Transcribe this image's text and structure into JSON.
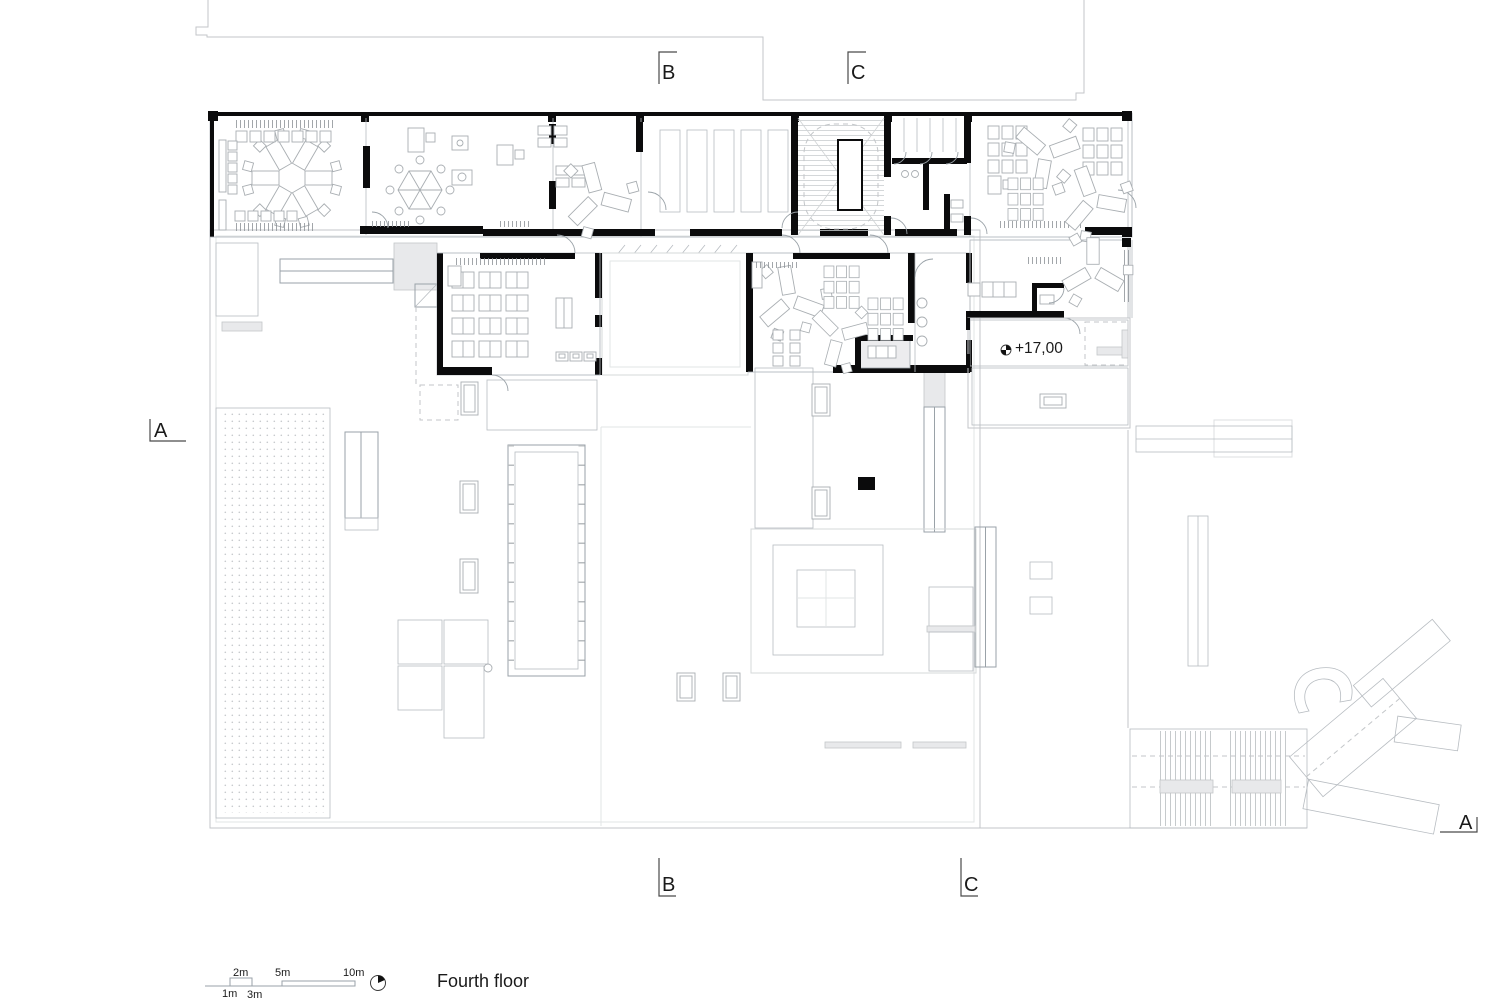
{
  "drawing": {
    "title": "Fourth floor",
    "elevation_label": "+17,00"
  },
  "section_markers": {
    "top_b": "B",
    "top_c": "C",
    "bottom_b": "B",
    "bottom_c": "C",
    "left_a": "A",
    "right_a": "A"
  },
  "scale_bar": {
    "labels": {
      "m1": "1m",
      "m2": "2m",
      "m3": "3m",
      "m5": "5m",
      "m10": "10m"
    }
  },
  "icons": {
    "north_arrow": "north-arrow-icon",
    "level_marker": "level-marker-icon"
  },
  "colors": {
    "background": "#ffffff",
    "highlight_fill": "#e9edf2",
    "wall": "#0b0b0c",
    "site_line": "#c3c6c9",
    "furniture_line": "#a9aeb2",
    "text": "#1a1a1a"
  }
}
